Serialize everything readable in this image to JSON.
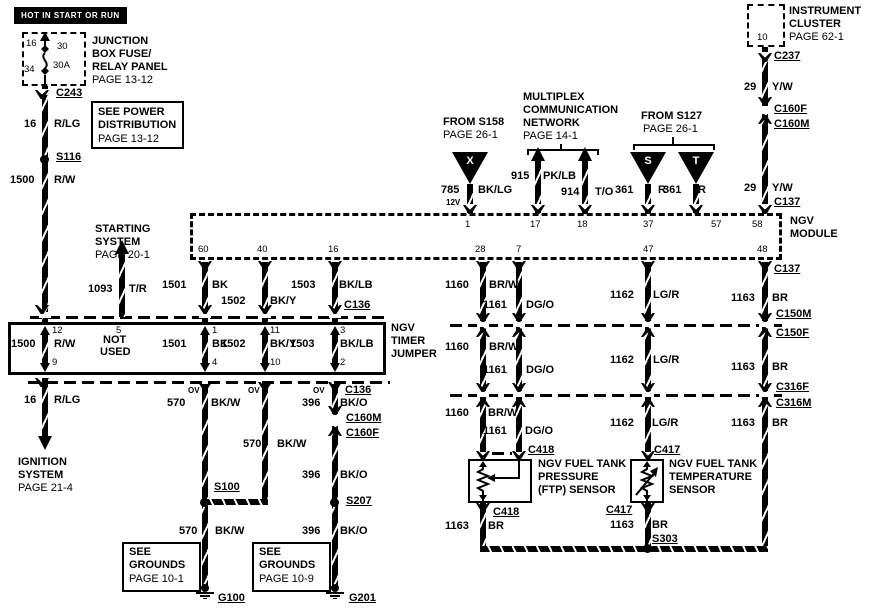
{
  "diagram": {
    "hot_tag": "HOT IN START OR RUN",
    "junction_box": {
      "line1": "JUNCTION",
      "line2": "BOX FUSE/",
      "line3": "RELAY PANEL",
      "page": "PAGE 13-12",
      "pin_tl": "16",
      "pin_tr": "30",
      "pin_bl": "34",
      "pin_br": "30A"
    },
    "see_power": {
      "line1": "SEE POWER",
      "line2": "DISTRIBUTION",
      "page": "PAGE 13-12"
    },
    "starting": {
      "line1": "STARTING",
      "line2": "SYSTEM",
      "page": "PAGE 20-1"
    },
    "ignition": {
      "line1": "IGNITION",
      "line2": "SYSTEM",
      "page": "PAGE 21-4"
    },
    "grounds_left": {
      "line1": "SEE",
      "line2": "GROUNDS",
      "page": "PAGE 10-1"
    },
    "grounds_right": {
      "line1": "SEE",
      "line2": "GROUNDS",
      "page": "PAGE 10-9"
    },
    "from_s158": {
      "title": "FROM S158",
      "page": "PAGE 26-1",
      "connector_letter": "X"
    },
    "multiplex": {
      "line1": "MULTIPLEX",
      "line2": "COMMUNICATION",
      "line3": "NETWORK",
      "page": "PAGE 14-1"
    },
    "from_s127": {
      "title": "FROM S127",
      "page": "PAGE 26-1",
      "connector_s": "S",
      "connector_t": "T"
    },
    "cluster": {
      "line1": "INSTRUMENT",
      "line2": "CLUSTER",
      "page": "PAGE 62-1",
      "pin": "10"
    },
    "module": {
      "line1": "NGV",
      "line2": "MODULE",
      "pin_1": "1",
      "pin_17": "17",
      "pin_18": "18",
      "pin_37": "37",
      "pin_57": "57",
      "pin_58": "58",
      "pin_60": "60",
      "pin_40": "40",
      "pin_16": "16",
      "pin_28": "28",
      "pin_7": "7",
      "pin_47": "47",
      "pin_48": "48"
    },
    "jumper": {
      "line1": "NGV",
      "line2": "TIMER",
      "line3": "JUMPER",
      "ov": "OV",
      "pin_12": "12",
      "pin_9": "9",
      "pin_5": "5",
      "not_used_1": "NOT",
      "not_used_2": "USED",
      "pin_1": "1",
      "pin_4": "4",
      "pin_11": "11",
      "pin_10": "10",
      "pin_3": "3",
      "pin_2": "2"
    },
    "ftp_sensor": {
      "line1": "NGV FUEL TANK",
      "line2": "PRESSURE",
      "line3": "(FTP) SENSOR"
    },
    "temp_sensor": {
      "line1": "NGV FUEL TANK",
      "line2": "TEMPERATURE",
      "line3": "SENSOR"
    }
  },
  "wires": {
    "w16": {
      "num": "16",
      "color": "R/LG"
    },
    "w1500": {
      "num": "1500",
      "color": "R/W"
    },
    "w1093": {
      "num": "1093",
      "color": "T/R"
    },
    "w1501": {
      "num": "1501",
      "color": "BK"
    },
    "w1502": {
      "num": "1502",
      "color": "BK/Y"
    },
    "w1503": {
      "num": "1503",
      "color": "BK/LB"
    },
    "w570": {
      "num": "570",
      "color": "BK/W"
    },
    "w396": {
      "num": "396",
      "color": "BK/O"
    },
    "w785": {
      "num": "785",
      "color": "BK/LG",
      "note": "12V"
    },
    "w915": {
      "num": "915",
      "color": "PK/LB"
    },
    "w914": {
      "num": "914",
      "color": "T/O"
    },
    "w361": {
      "num": "361",
      "color": "R"
    },
    "w29": {
      "num": "29",
      "color": "Y/W"
    },
    "w1160": {
      "num": "1160",
      "color": "BR/W"
    },
    "w1161": {
      "num": "1161",
      "color": "DG/O"
    },
    "w1162": {
      "num": "1162",
      "color": "LG/R"
    },
    "w1163": {
      "num": "1163",
      "color": "BR"
    }
  },
  "connectors": {
    "c243": "C243",
    "c237": "C237",
    "c160f": "C160F",
    "c160m": "C160M",
    "c137": "C137",
    "c136": "C136",
    "c150m": "C150M",
    "c150f": "C150F",
    "c316f": "C316F",
    "c316m": "C316M",
    "c418": "C418",
    "c417": "C417"
  },
  "splices": {
    "s116": "S116",
    "s100": "S100",
    "s207": "S207",
    "s303": "S303"
  },
  "grounds": {
    "g100": "G100",
    "g201": "G201"
  }
}
